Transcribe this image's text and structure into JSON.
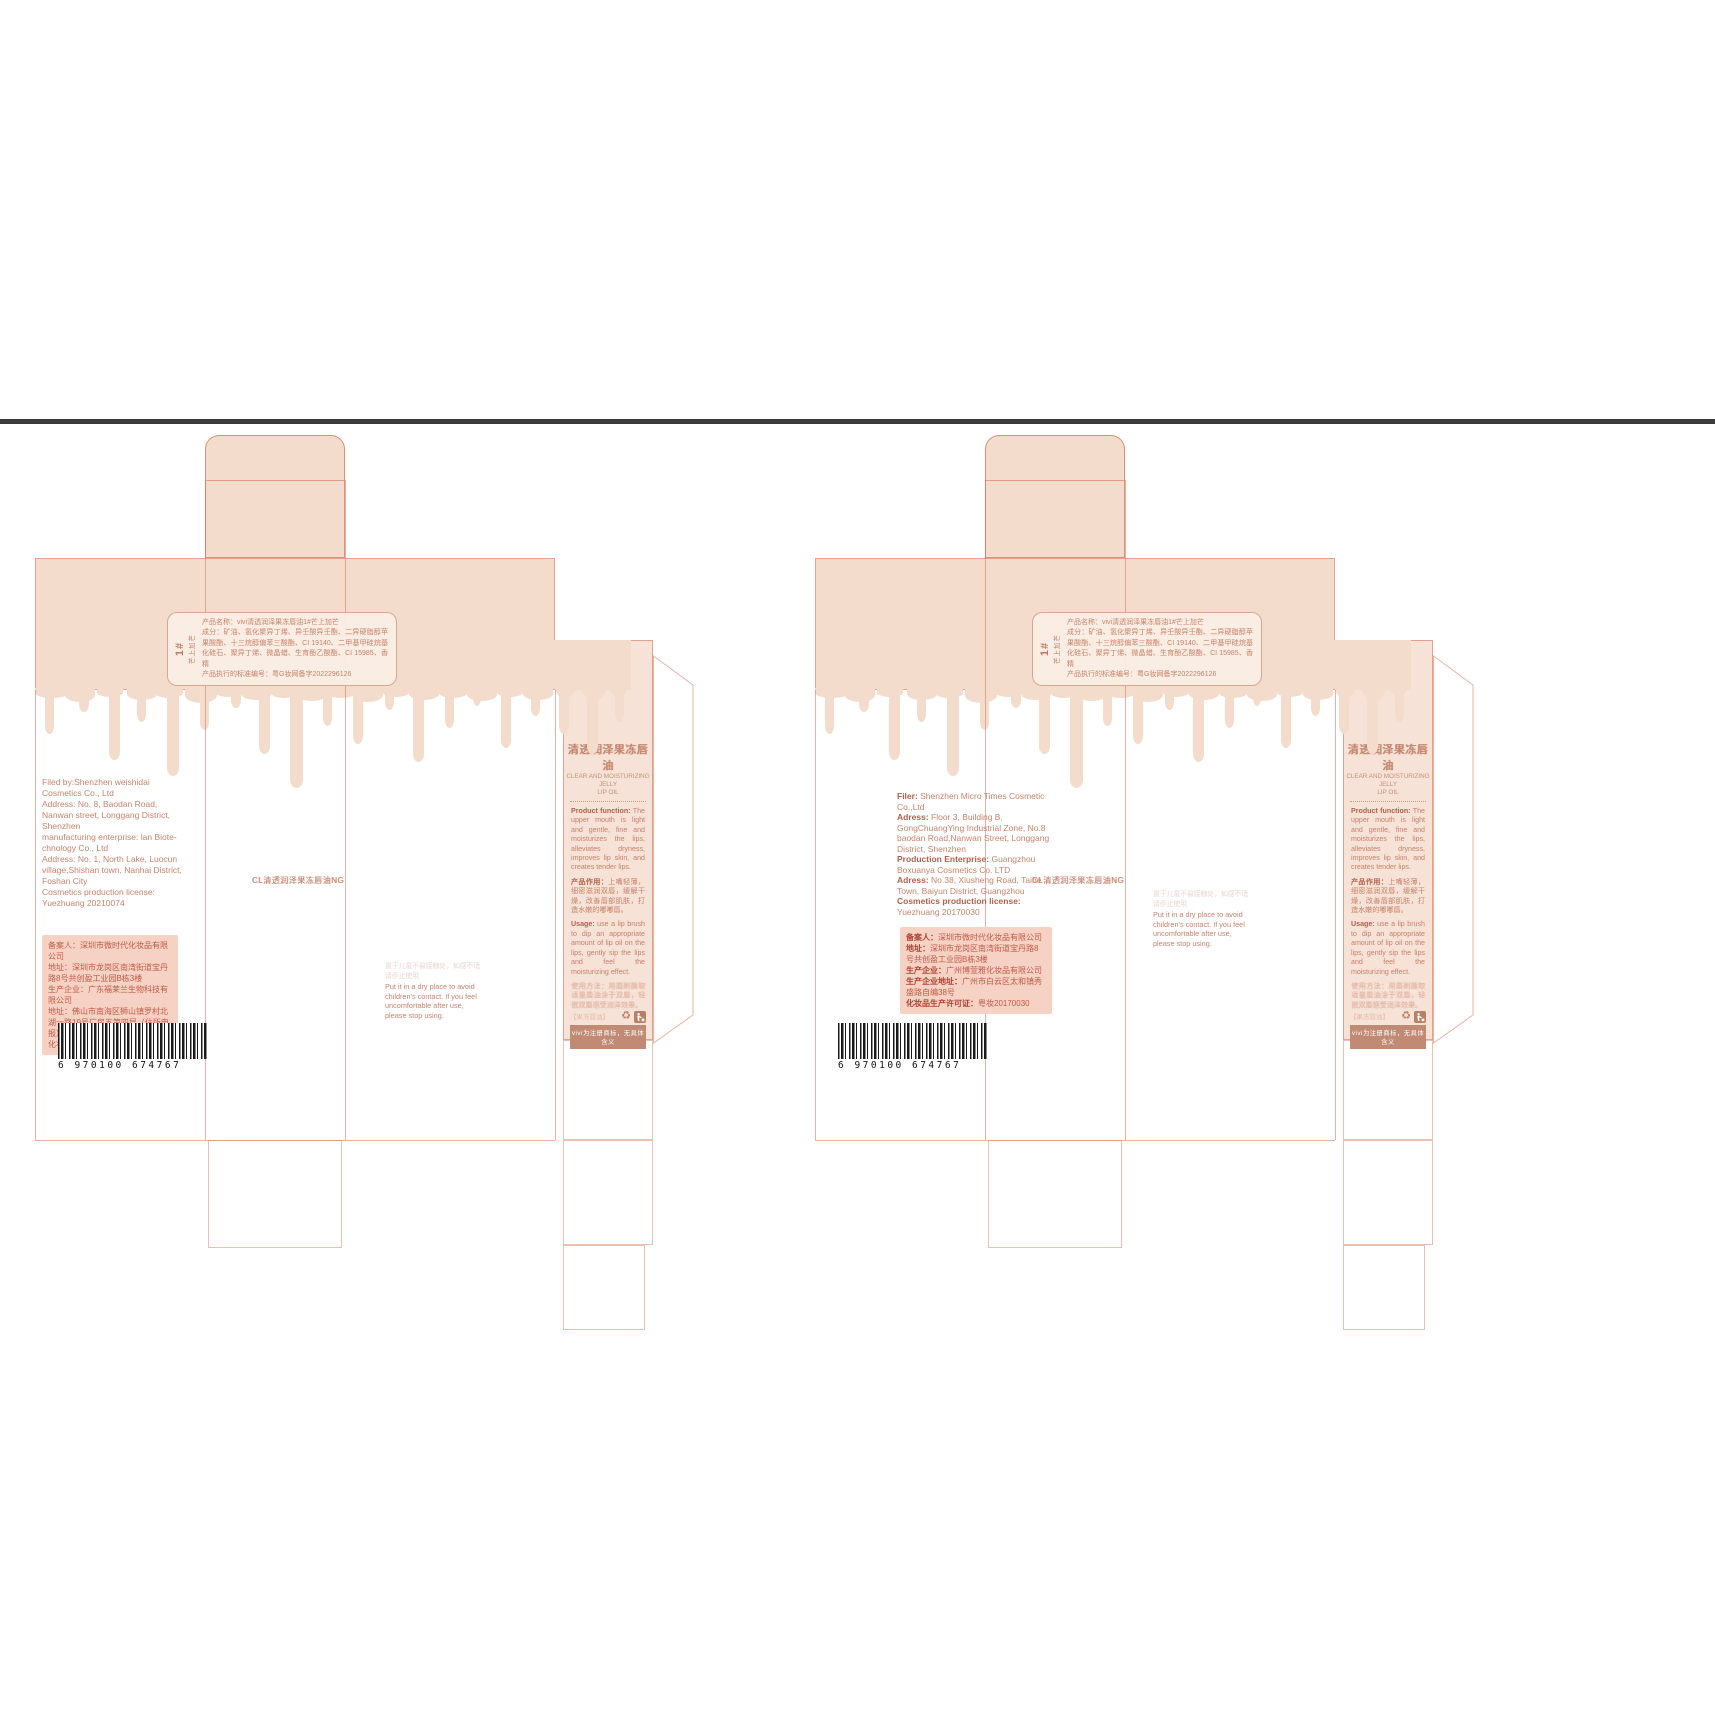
{
  "colors": {
    "drip_pink": "#f4dccd",
    "panel_beige": "#f6e2d6",
    "line_red": "#d6745c",
    "text_brown": "#c9836c",
    "box_pink": "#f6d2c5",
    "bar_brown": "#c08a74",
    "rule_dark": "#3b3b3d",
    "barcode_black": "#1a1a1a"
  },
  "shared": {
    "tag_number": "1#",
    "tag_variant": "芒上加芒",
    "ingredients_text": "产品名称：vivi清透润泽果冻唇油1#芒上加芒\n成分：矿油、氢化聚异丁烯、异壬酸异壬酯、二异硬脂醇苹果酸酯、十三烷醇偏苯三酸酯、CI 19140、二甲基甲硅烷基化硅石、聚异丁烯、微晶蜡、生育酚乙酸酯、CI 15985、香精\n产品执行的标准编号：粤G妆网备字2022296126",
    "front_overlap_text": "CL清透润泽果冻唇油NG",
    "warning_faint": "置于儿童不易接触处，如感不适请停止使用",
    "warning_text": "Put it in a dry place to avoid children's contact. If you feel uncomfortable after use, please stop using.",
    "barcode_digits": "6 970100 674767",
    "panel": {
      "title_cn": "清透润泽果冻唇油",
      "title_en1": "CLEAR AND MOISTURIZING JELLY",
      "title_en2": "LIP OIL",
      "fn_label": "Product function:",
      "fn_text": " The upper mouth is light and gentle, fine and moisturizes the lips, alleviates dryness, improves lip skin, and creates tender lips.",
      "cn_label": "产品作用：",
      "cn_text": "上嘴轻薄，细密滋润双唇，缓解干燥，改善唇部肌肤，打造水嫩的嘟嘟唇。",
      "usage_label": "Usage:",
      "usage_text": " use a lip brush to dip an appropriate amount of lip oil on the lips, gently sip the lips and feel the moisturizing effect.",
      "usage_cn_faint": "使用方法：用唇刷蘸取适量唇油涂于双唇，轻抿双唇感受润泽效果。",
      "bottom_faint": "【果冻唇油】",
      "trademark_note": "vivi为注册商标，无具体含义"
    }
  },
  "left": {
    "filing_text": "Filed by:Shenzhen weishidai Cosmetics Co., Ltd\nAddress: No. 8, Baodan Road, Nanwan street, Longgang District, Shenzhen\nmanufacturing enterprise: lan Biote-chnology Co., Ltd\nAddress: No. 1, North Lake, Luocun village,Shishan town, Nanhai District, Foshan City\nCosmetics production license: Yuezhuang 20210074",
    "pink_text": "备案人：深圳市微时代化妆品有限公司\n地址：深圳市龙岗区南湾街道宝丹路8号共创盈工业园B栋3楼\n生产企业：广东福莱兰生物科技有限公司\n地址：佛山市南海区狮山镇罗村北湖一路19号厂房五第四层（住所申报）\n化妆品生产许可证：粤妆20210074"
  },
  "right": {
    "filing": [
      {
        "label": "Filer:",
        "text": " Shenzhen Micro Times Cosmetic Co.,Ltd"
      },
      {
        "label": "Adress:",
        "text": " Floor 3, Building B, GongChuangYing Industrial Zone, No.8 baodan Road,Nanwan Street, Longgang District, Shenzhen"
      },
      {
        "label": "Production Enterprise:",
        "text": " Guangzhou Boxuanya Cosmetics Co. LTD"
      },
      {
        "label": "Adress:",
        "text": " No.38, Xiusheng Road, Taihe Town, Baiyun District, Guangzhou"
      },
      {
        "label": "Cosmetics production license:",
        "text": " Yuezhuang 20170030"
      }
    ],
    "pink": [
      {
        "label": "备案人：",
        "text": "深圳市微时代化妆品有限公司"
      },
      {
        "label": "地址：",
        "text": "深圳市龙岗区南湾街道宝丹路8号共创盈工业园B栋3楼"
      },
      {
        "label": "生产企业：",
        "text": "广州博萱雅化妆品有限公司"
      },
      {
        "label": "生产企业地址：",
        "text": "广州市白云区太和镇秀盛路自编38号"
      },
      {
        "label": "化妆品生产许可证：",
        "text": "粤妆20170030"
      }
    ]
  }
}
